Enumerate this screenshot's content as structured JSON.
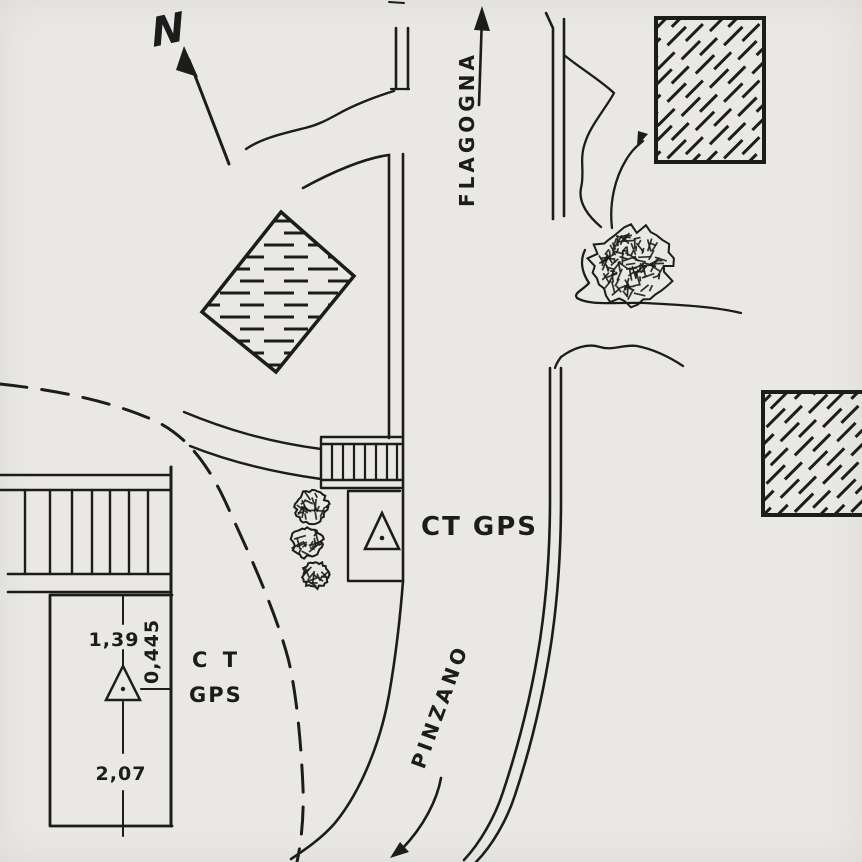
{
  "colors": {
    "ink": "#1c1c1c",
    "paper": "#e9e8e5"
  },
  "compass": {
    "label": "N"
  },
  "destinations": {
    "north_road": {
      "label": "FLAGOGNA"
    },
    "south_road": {
      "label": "PINZANO"
    }
  },
  "stations": {
    "roadside": {
      "label": "CT GPS",
      "symbol": "triangle-with-dot"
    },
    "courtyard": {
      "label_line1": "C T",
      "label_line2": "GPS",
      "symbol": "triangle-with-dot",
      "measurements": {
        "to_north_wall": "1,39",
        "to_east_wall": "0,445",
        "to_south_wall": "2,07"
      }
    }
  }
}
